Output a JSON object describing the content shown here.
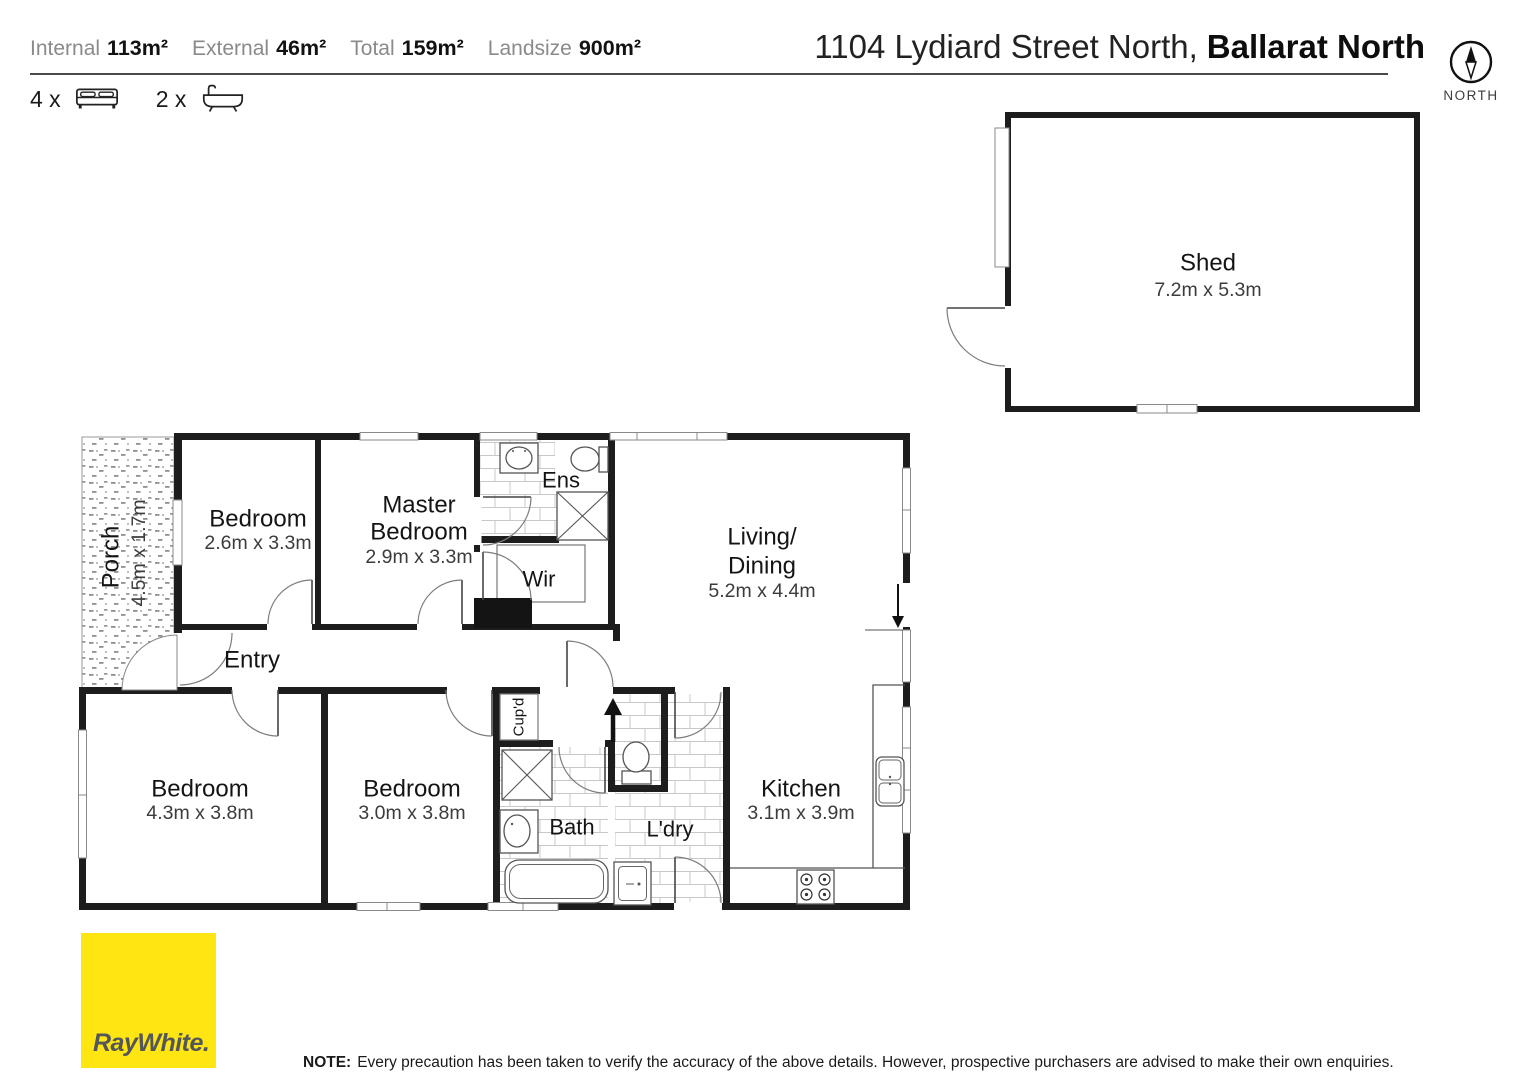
{
  "header": {
    "stats": [
      {
        "label": "Internal",
        "value": "113m²"
      },
      {
        "label": "External",
        "value": "46m²"
      },
      {
        "label": "Total",
        "value": "159m²"
      },
      {
        "label": "Landsize",
        "value": "900m²"
      }
    ],
    "bed_count": "4 x",
    "bath_count": "2 x",
    "address_regular": "1104 Lydiard Street North,",
    "address_bold": "Ballarat North",
    "compass_label": "NORTH"
  },
  "floorplan": {
    "shed": {
      "name": "Shed",
      "dims": "7.2m x 5.3m"
    },
    "porch": {
      "name": "Porch",
      "dims": "4.5m x 1.7m"
    },
    "bedroom_top_left": {
      "name": "Bedroom",
      "dims": "2.6m x 3.3m"
    },
    "master_bedroom": {
      "line1": "Master",
      "line2": "Bedroom",
      "dims": "2.9m x 3.3m"
    },
    "ens": {
      "name": "Ens"
    },
    "wir": {
      "name": "Wir"
    },
    "living_dining": {
      "line1": "Living/",
      "line2": "Dining",
      "dims": "5.2m x 4.4m"
    },
    "entry": {
      "name": "Entry"
    },
    "cupboard": {
      "name": "Cup'd"
    },
    "bath": {
      "name": "Bath"
    },
    "laundry": {
      "name": "L'dry"
    },
    "kitchen": {
      "name": "Kitchen",
      "dims": "3.1m x 3.9m"
    },
    "bedroom_bottom_left": {
      "name": "Bedroom",
      "dims": "4.3m x 3.8m"
    },
    "bedroom_bottom_mid": {
      "name": "Bedroom",
      "dims": "3.0m x 3.8m"
    }
  },
  "footer": {
    "logo_text": "RayWhite.",
    "note_label": "NOTE:",
    "note_text": "Every precaution has been taken to verify the accuracy of the above details. However, prospective purchasers are advised to make their own enquiries."
  },
  "colors": {
    "brand_yellow": "#FFE512",
    "logo_text_color": "#53565A",
    "wall": "#1D1D1D"
  }
}
